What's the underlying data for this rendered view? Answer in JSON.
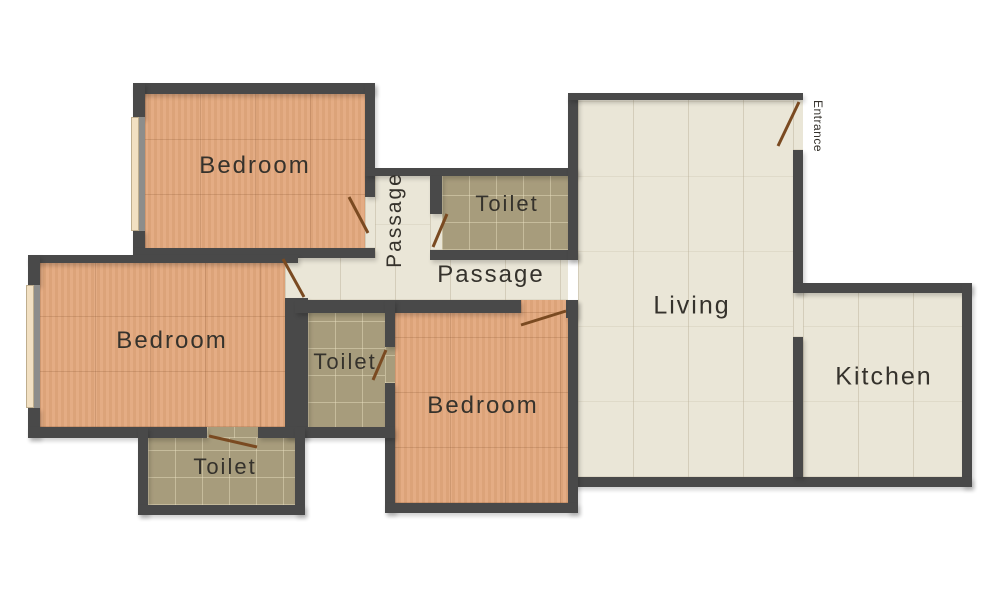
{
  "plan_type": "residential floor plan",
  "rooms": {
    "bedroom1": {
      "label": "Bedroom"
    },
    "passage_vertical": {
      "label": "Passage"
    },
    "toilet1": {
      "label": "Toilet"
    },
    "passage_main": {
      "label": "Passage"
    },
    "living": {
      "label": "Living"
    },
    "entrance": {
      "label": "Entrance"
    },
    "bedroom2": {
      "label": "Bedroom"
    },
    "toilet2": {
      "label": "Toilet"
    },
    "bedroom3": {
      "label": "Bedroom"
    },
    "kitchen": {
      "label": "Kitchen"
    },
    "toilet3": {
      "label": "Toilet"
    }
  },
  "colors": {
    "wall": "#494949",
    "bedroom_floor": "#e3a87d",
    "toilet_floor": "#a79c7c",
    "living_floor": "#eae6d7",
    "door_swing": "#7a4a21",
    "window": "#f2e0c2",
    "label_text": "#35322c",
    "background": "#ffffff"
  }
}
